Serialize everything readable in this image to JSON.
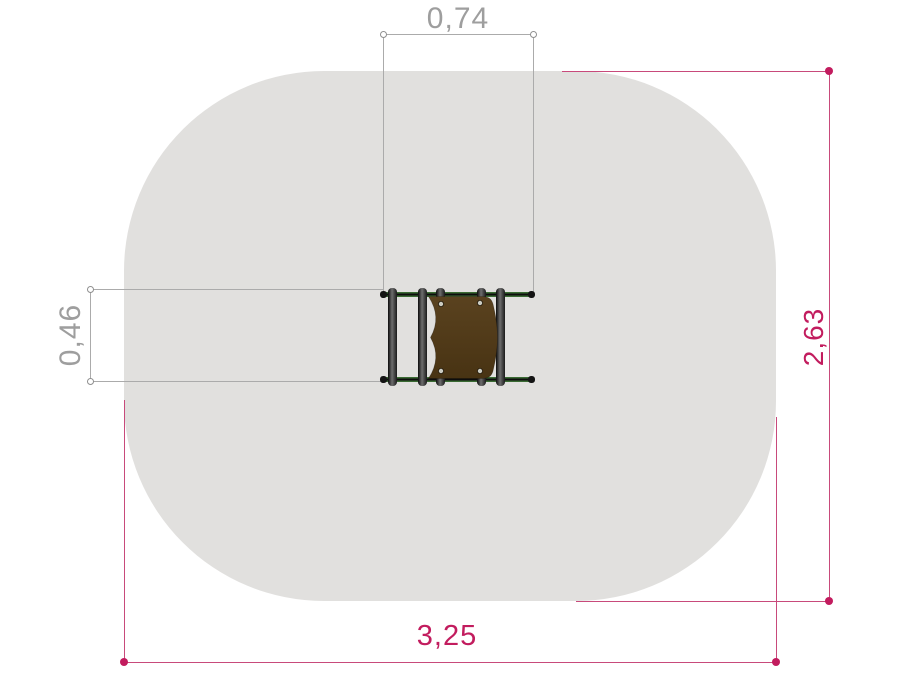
{
  "diagram": {
    "kind": "playground equipment plan view with safety-zone dimensions",
    "labels": {
      "top_width": "0,74",
      "left_depth": "0,46",
      "right_height": "2,63",
      "bottom_width": "3,25"
    },
    "colors": {
      "zone_fill": "#e1e0de",
      "dim_gray_line": "#ababab",
      "dim_gray_text": "#9e9e9e",
      "dim_magenta": "#c21c5e",
      "dim_magenta_line": "#c84a7b",
      "rail_green": "#3a6b33",
      "post_dark": "#141414",
      "panel_brown": "#4f3917"
    }
  }
}
